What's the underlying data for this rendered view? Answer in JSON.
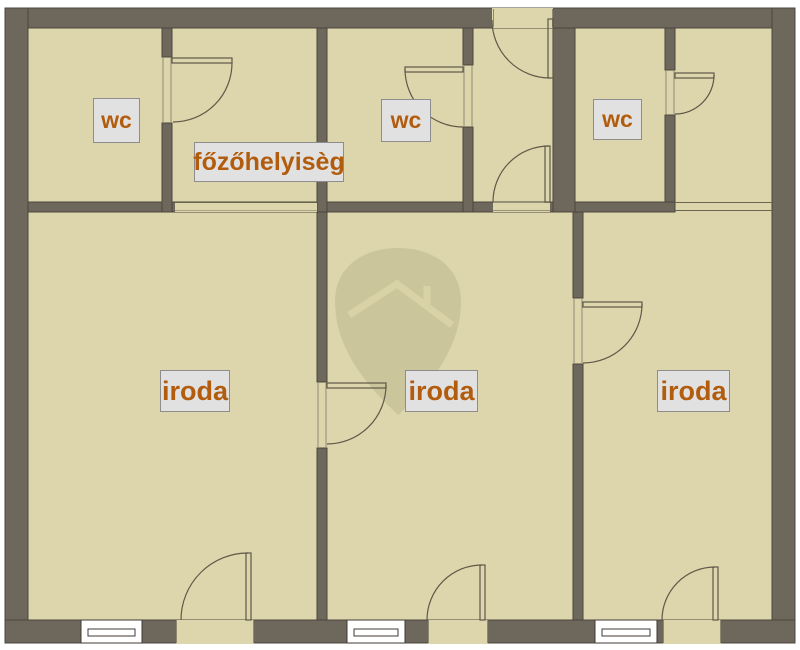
{
  "rooms": {
    "wc_left": {
      "label": "wc"
    },
    "cooking_room": {
      "label": "főzőhelyisèg"
    },
    "wc_middle": {
      "label": "wc"
    },
    "wc_right": {
      "label": "wc"
    },
    "office_left": {
      "label": "iroda"
    },
    "office_middle": {
      "label": "iroda"
    },
    "office_right": {
      "label": "iroda"
    }
  },
  "watermark": {
    "icon": "house-pin-icon"
  },
  "colors": {
    "background": "#ffffff",
    "floor": "#ddd6ac",
    "wall": "#6e675c",
    "wall_outline": "#4c463e",
    "door_line": "#5f5848",
    "jamb_line": "#8f8974",
    "opening_line": "#6b654f",
    "window_line": "#3f3a33",
    "label_bg": "#e1e1e1",
    "label_border": "#8d8d8d",
    "label_text": "#b25c0e",
    "watermark_fill": "#cbc59b",
    "watermark_line": "#d8d2a6"
  }
}
